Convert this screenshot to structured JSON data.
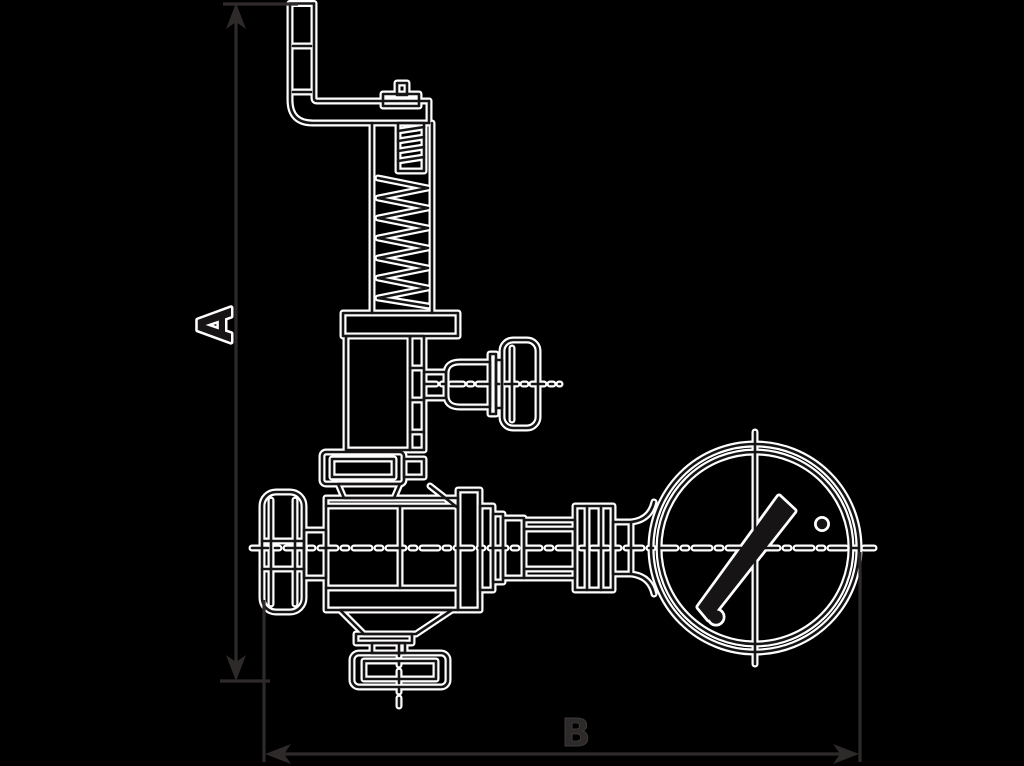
{
  "page": {
    "background": "#000000"
  },
  "drawing": {
    "labels": {
      "dim_vertical": "A",
      "dim_horizontal": "B"
    },
    "colors": {
      "background": "#000000",
      "line_casing": "#ffffff",
      "ink": "#171416",
      "dimension": "#2e2a2a"
    }
  }
}
